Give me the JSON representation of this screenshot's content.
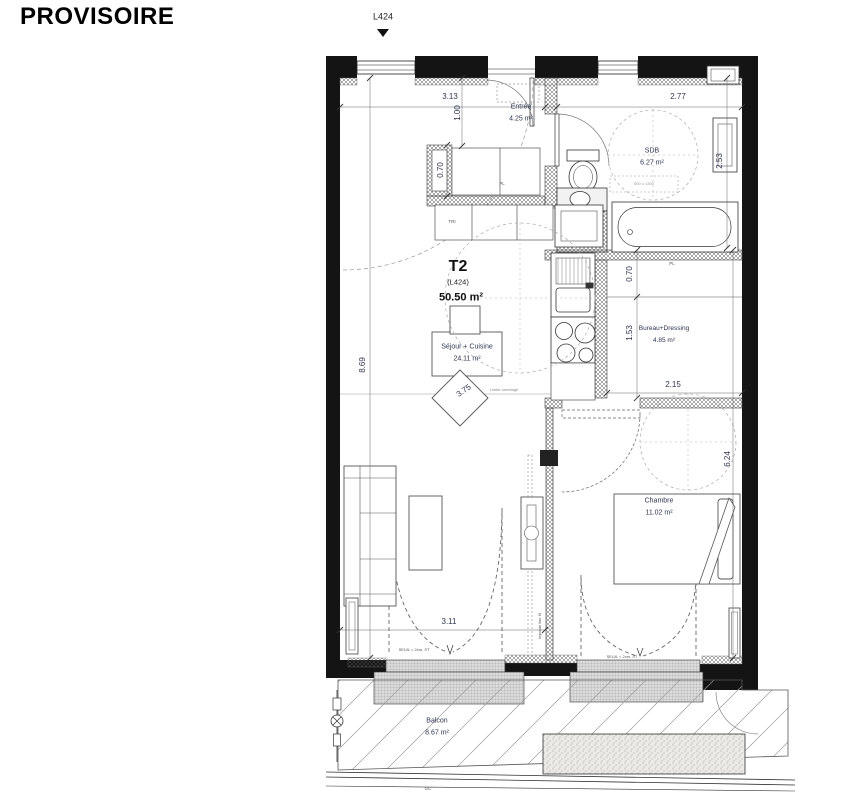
{
  "stamp": "PROVISOIRE",
  "marker": {
    "label": "L424"
  },
  "title_block": {
    "type": "T2",
    "lot": "(L424)",
    "total_area": "50.50 m²"
  },
  "rooms": {
    "entree": {
      "name": "Entrée",
      "area": "4.25 m²"
    },
    "sdb": {
      "name": "SDB",
      "area": "6.27 m²"
    },
    "sejour": {
      "name": "Séjour + Cuisine",
      "area": "24.11 m²"
    },
    "bureau": {
      "name": "Bureau+Dressing",
      "area": "4.85 m²"
    },
    "chambre": {
      "name": "Chambre",
      "area": "11.02 m²"
    },
    "balcon": {
      "name": "Balcon",
      "area": "8.67 m²"
    }
  },
  "dimensions": {
    "entree_width": "3.13",
    "entree_depth": "1.00",
    "sdb_width": "2.77",
    "sdb_depth": "2.53",
    "closet_depth": "0.70",
    "sejour_height": "8.69",
    "sejour_diag": "3.75",
    "bureau_strip": "0.70",
    "bureau_height": "1.53",
    "bureau_width": "2.15",
    "chambre_height": "6.24",
    "sejour_door_width": "3.11"
  },
  "annotations": {
    "seuil": "SEUIL < 2cm, ST",
    "limite_carrelage": "Limite carrelage",
    "imposte": "Imposte fixe M",
    "tub_size": "600 x 1300",
    "tri": "TRI",
    "pl": "PL",
    "gc": "GC"
  },
  "colors": {
    "wall": "#141414",
    "dim_text": "#2e3550",
    "line": "#444"
  }
}
